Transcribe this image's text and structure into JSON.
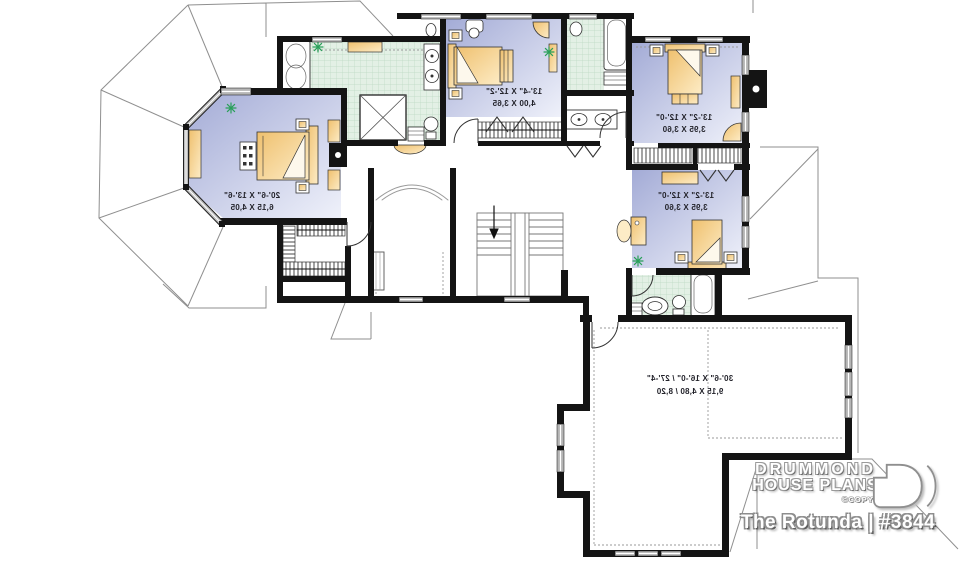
{
  "plan": {
    "rooms": {
      "master_bedroom": {
        "label_imperial": "20'-6\" X 13'-6\"",
        "label_metric": "6,15 X 4,05"
      },
      "bedroom_2": {
        "label_imperial": "13'-4\" X 12'-2\"",
        "label_metric": "4,00 X 3,65"
      },
      "bedroom_3": {
        "label_imperial": "13'-2\" X 12'-0\"",
        "label_metric": "3,95 X 3,60"
      },
      "bedroom_4": {
        "label_imperial": "13'-2\" X 12'-0\"",
        "label_metric": "3,95 X 3,60"
      },
      "bonus_room": {
        "label_imperial": "30'-6\" X 16'-0\" / 27'-4\"",
        "label_metric": "9,15 X 4,80 / 8,20"
      }
    }
  },
  "branding": {
    "name_line1": "DRUMMOND",
    "name_line2": "HOUSE PLANS",
    "copyright": "©COPYRIGHT",
    "plan_title": "The Rotunda | #3844",
    "logo_icon": "drummond-d-mark"
  },
  "colors": {
    "wall": "#141414",
    "bedroom_floor_dark": "#a3abd6",
    "bedroom_floor_light": "#eff1fa",
    "bath_tile": "#e3f0e5",
    "bath_tile_line": "#bcd9c3",
    "furniture": "#f0c277",
    "furniture_light": "#fdecc6",
    "plant": "#2aa05a",
    "roof_line": "#8f8f8f"
  }
}
